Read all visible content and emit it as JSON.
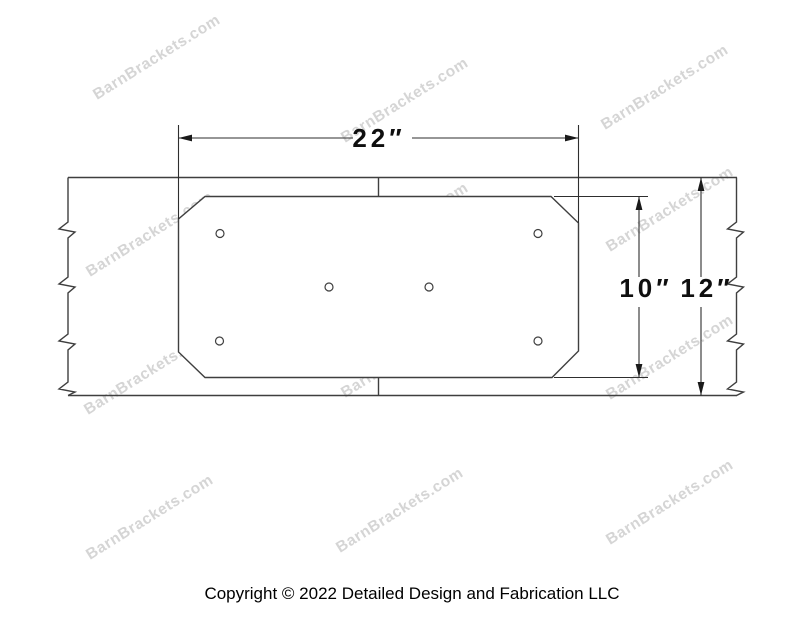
{
  "page": {
    "background": "#ffffff",
    "width_px": 800,
    "height_px": 618
  },
  "watermark": {
    "text": "BarnBrackets.com"
  },
  "drawing": {
    "subject_counts": {
      "bolt_holes": 6,
      "beam_break_marks_per_edge": 4
    },
    "dimensions": [
      {
        "name": "plate-width",
        "label": "22″",
        "value": 22,
        "unit": "inches"
      },
      {
        "name": "plate-height",
        "label": "10″",
        "value": 10,
        "unit": "inches"
      },
      {
        "name": "beam-height",
        "label": "12″",
        "value": 12,
        "unit": "inches"
      }
    ]
  },
  "footer": {
    "copyright": "Copyright © 2022 Detailed Design and Fabrication LLC"
  },
  "colors": {
    "line": "#3f3f3f",
    "dimension_text": "#0f0f0f",
    "watermark": "#d5d5d5",
    "copyright_text": "#000000",
    "background": "#ffffff"
  }
}
